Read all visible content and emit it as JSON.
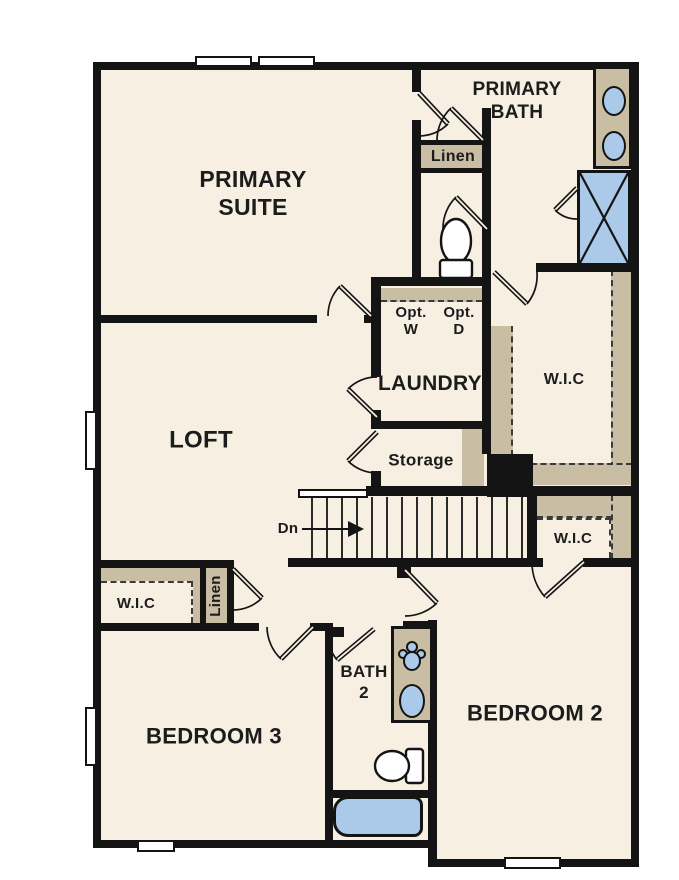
{
  "rooms": {
    "primary_suite": "PRIMARY\nSUITE",
    "primary_bath": "PRIMARY\nBATH",
    "loft": "LOFT",
    "laundry": "LAUNDRY",
    "storage": "Storage",
    "bedroom_2": "BEDROOM 2",
    "bedroom_3": "BEDROOM 3",
    "bath_2": "BATH\n2",
    "wic_primary": "W.I.C",
    "wic_bedroom2": "W.I.C",
    "wic_bedroom3": "W.I.C",
    "linen_bath": "Linen",
    "linen_hall": "Linen",
    "opt_washer": "Opt.\nW",
    "opt_dryer": "Opt.\nD",
    "stairs_down": "Dn"
  },
  "colors": {
    "floor": "#f6efe2",
    "wall": "#141414",
    "casework": "#c9bda3",
    "fixture_blue": "#abc9e8",
    "appliance_gray": "#dbdbdb"
  }
}
